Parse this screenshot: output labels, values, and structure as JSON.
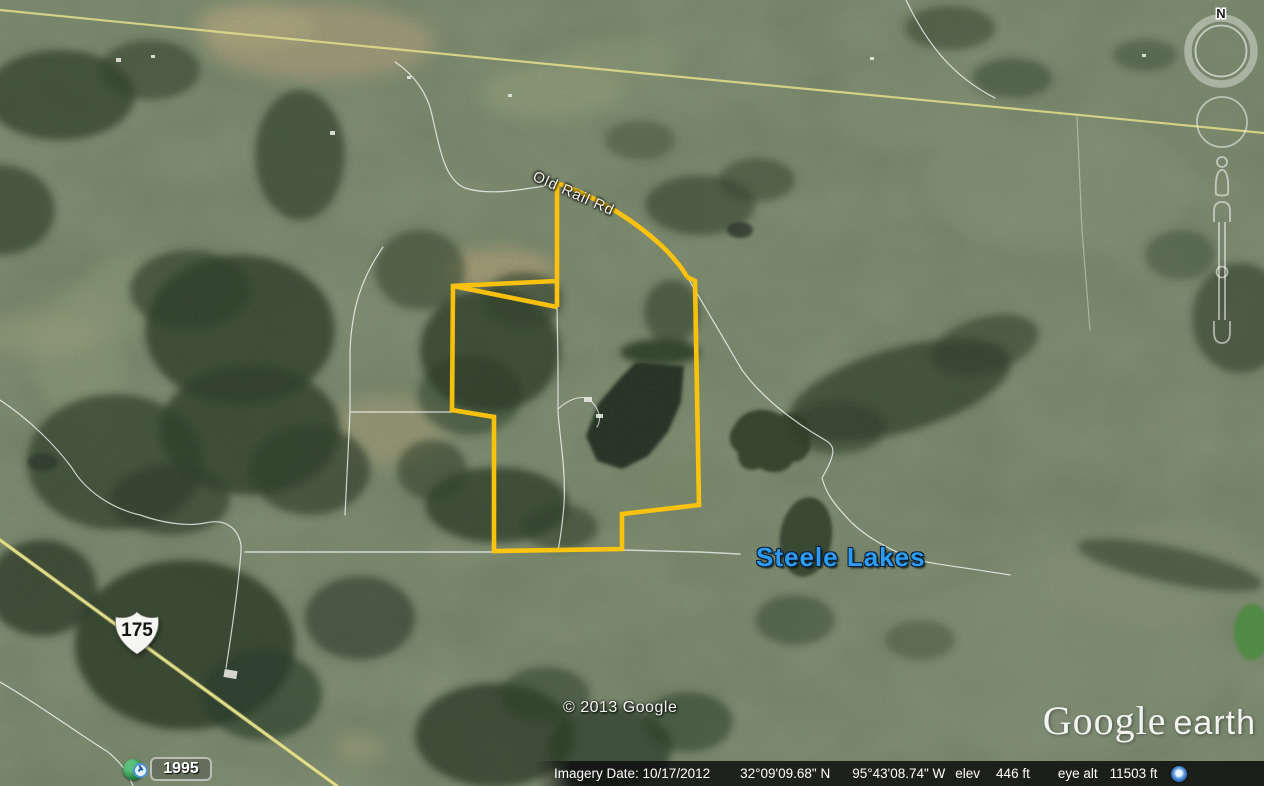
{
  "map": {
    "road_label": "Old Rail Rd",
    "place_label": "Steele Lakes",
    "highway_shield": "175",
    "copyright": "© 2013 Google",
    "historical_imagery_year": "1995",
    "colors": {
      "property_boundary": "#fec50a",
      "place_label_blue": "#2f9bf0",
      "road_yellow": "#e6e08a"
    }
  },
  "logo": {
    "primary": "Google",
    "secondary": "earth"
  },
  "navigation": {
    "north_label": "N"
  },
  "status_bar": {
    "imagery_date": "Imagery Date: 10/17/2012",
    "latitude": "32°09'09.68\" N",
    "longitude": "95°43'08.74\" W",
    "elev_label": "elev",
    "elevation": "446 ft",
    "eye_alt_label": "eye alt",
    "eye_altitude": "11503 ft"
  }
}
